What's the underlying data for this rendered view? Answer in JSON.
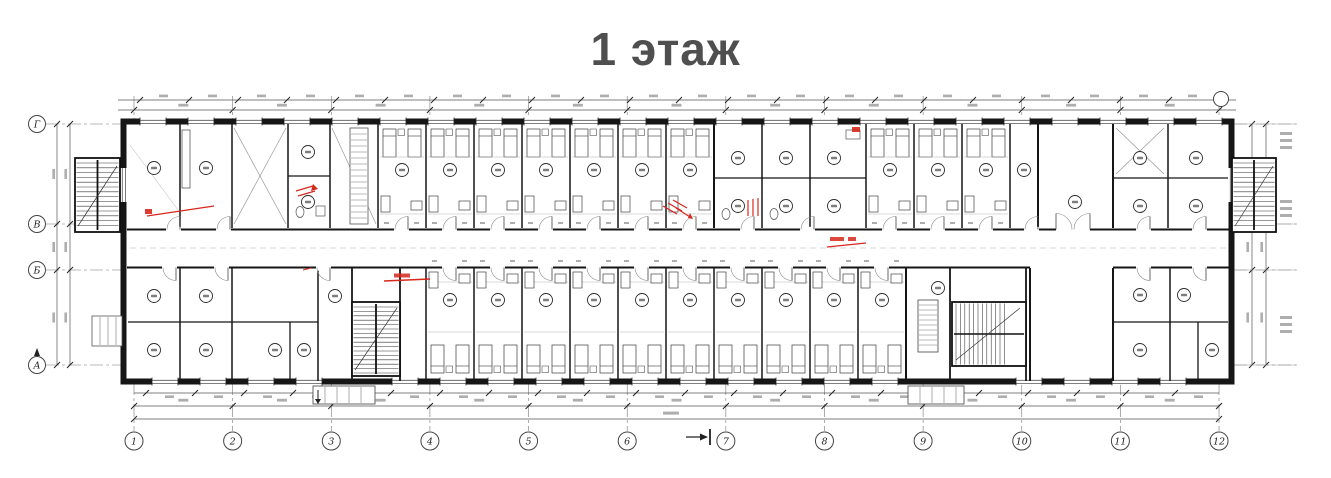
{
  "title": {
    "text": "1 этаж"
  },
  "axes": {
    "letters": [
      "Г",
      "В",
      "Б",
      "А"
    ],
    "numbers": [
      "1",
      "2",
      "3",
      "4",
      "5",
      "6",
      "7",
      "8",
      "9",
      "10",
      "11",
      "12"
    ]
  },
  "drawing": {
    "type": "architectural-floor-plan",
    "floor_label": "1 этаж",
    "features": [
      "dormitory-rooms",
      "central-corridor",
      "four-staircases",
      "sanitary-blocks",
      "red-markup-annotations",
      "dimension-chains"
    ]
  },
  "colors": {
    "wall": "#161616",
    "line": "#444444",
    "thin": "#8a8a8a",
    "faint": "#bbbbbb",
    "red": "#d7281c",
    "title": "#4f4f4f",
    "background": "#ffffff"
  }
}
